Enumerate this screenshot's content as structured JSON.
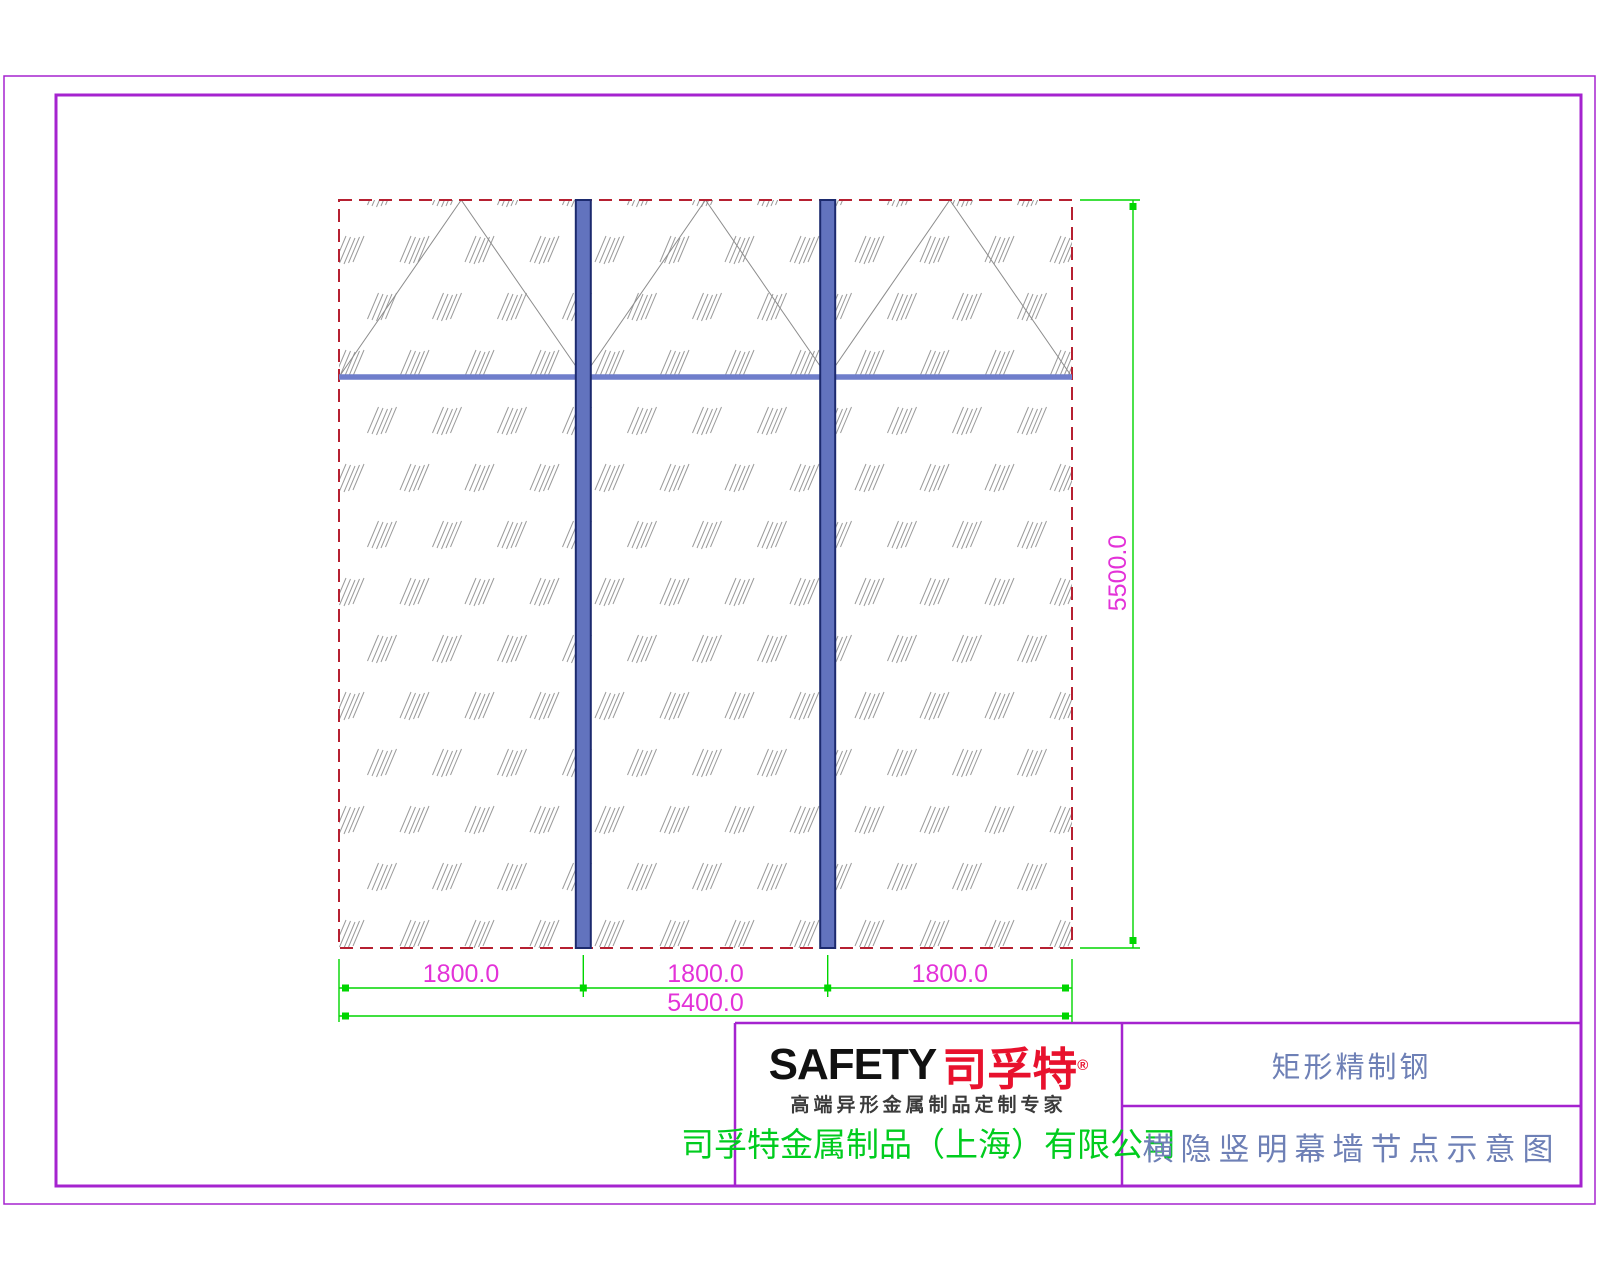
{
  "drawing": {
    "panel_dim_labels": [
      "1800.0",
      "1800.0",
      "1800.0"
    ],
    "total_width_label": "5400.0",
    "total_height_label": "5500.0",
    "colors": {
      "frame_border": "#a523cf",
      "panel_dashed_border": "#b62031",
      "mullion_fill": "#6273be",
      "mullion_edge": "#1c2a6e",
      "transom_line": "#6f7ecb",
      "dimension_line": "#00d600",
      "dimension_text": "#e332d8",
      "hatch": "#9b9b9b",
      "opening_symbol": "#8c8c8c"
    }
  },
  "title_block": {
    "logo_en": "SAFETY",
    "logo_cn": "司孚特",
    "registered": "®",
    "tagline": "高端异形金属制品定制专家",
    "company": "司孚特金属制品（上海）有限公司",
    "product": "矩形精制钢",
    "drawing_title": "横隐竖明幕墙节点示意图"
  }
}
